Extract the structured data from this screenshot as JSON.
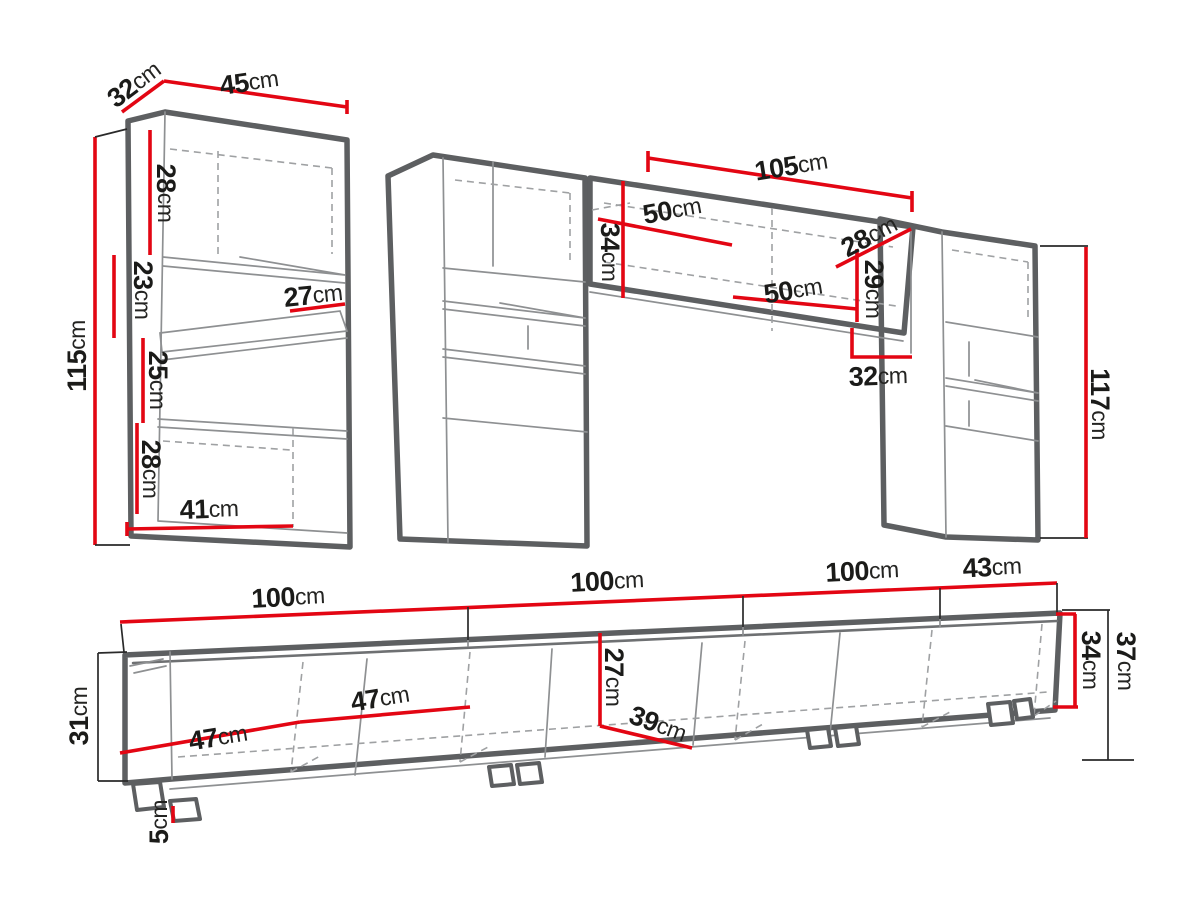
{
  "diagram": {
    "unit": "cm",
    "left_cabinet": {
      "depth": {
        "n": "32",
        "u": "cm"
      },
      "width": {
        "n": "45",
        "u": "cm"
      },
      "height": {
        "n": "115",
        "u": "cm"
      },
      "section_top": {
        "n": "28",
        "u": "cm"
      },
      "section_upper_mid": {
        "n": "23",
        "u": "cm"
      },
      "section_lower_mid": {
        "n": "25",
        "u": "cm"
      },
      "section_bottom": {
        "n": "28",
        "u": "cm"
      },
      "shelf_depth": {
        "n": "27",
        "u": "cm"
      },
      "bottom_width": {
        "n": "41",
        "u": "cm"
      }
    },
    "wall_shelf": {
      "width": {
        "n": "105",
        "u": "cm"
      },
      "left_inner_width": {
        "n": "50",
        "u": "cm"
      },
      "height": {
        "n": "34",
        "u": "cm"
      },
      "depth": {
        "n": "28",
        "u": "cm"
      },
      "right_inner_height": {
        "n": "29",
        "u": "cm"
      },
      "right_inner_width": {
        "n": "50",
        "u": "cm"
      },
      "end_width": {
        "n": "32",
        "u": "cm"
      }
    },
    "right_cabinet": {
      "height": {
        "n": "117",
        "u": "cm"
      }
    },
    "tv_stand": {
      "segment1": {
        "n": "100",
        "u": "cm"
      },
      "segment2": {
        "n": "100",
        "u": "cm"
      },
      "segment3": {
        "n": "100",
        "u": "cm"
      },
      "segment4": {
        "n": "43",
        "u": "cm"
      },
      "height_left": {
        "n": "31",
        "u": "cm"
      },
      "door_width_left": {
        "n": "47",
        "u": "cm"
      },
      "door_width_mid": {
        "n": "47",
        "u": "cm"
      },
      "inner_height": {
        "n": "27",
        "u": "cm"
      },
      "shelf_depth": {
        "n": "39",
        "u": "cm"
      },
      "inner_height_right": {
        "n": "34",
        "u": "cm"
      },
      "height_right": {
        "n": "37",
        "u": "cm"
      },
      "foot_height": {
        "n": "5",
        "u": "cm"
      }
    },
    "colors": {
      "dimension_red": "#e30613",
      "outline_gray": "#5d5f61",
      "text": "#1b1b19"
    }
  }
}
